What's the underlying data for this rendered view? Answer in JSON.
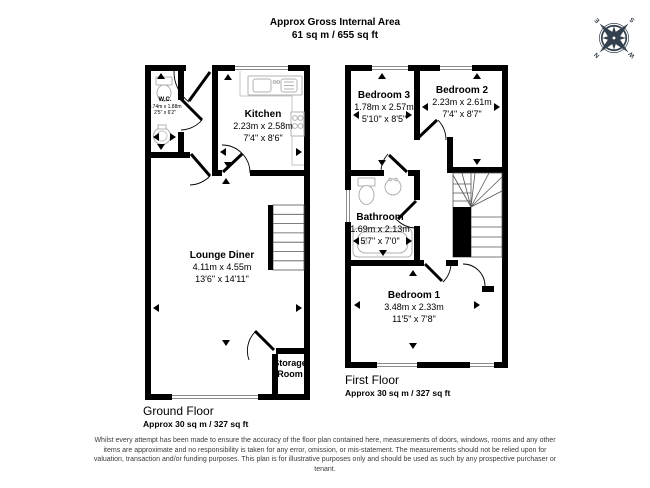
{
  "header": {
    "line1": "Approx Gross Internal Area",
    "line2": "61 sq m / 655 sq ft"
  },
  "compass": {
    "n": "N",
    "e": "E",
    "s": "S",
    "w": "W"
  },
  "ground": {
    "floor_label": "Ground Floor",
    "floor_area": "Approx 30 sq m / 327 sq ft",
    "rooms": {
      "wc": {
        "name": "W.C.",
        "metric": "0.74m x 1.88m",
        "imperial": "2'5\" x 6'2\""
      },
      "kitchen": {
        "name": "Kitchen",
        "metric": "2.23m x 2.58m",
        "imperial": "7'4\" x 8'6\""
      },
      "lounge": {
        "name": "Lounge Diner",
        "metric": "4.11m x 4.55m",
        "imperial": "13'6\" x 14'11\""
      },
      "storage": {
        "name": "Storage Room"
      }
    }
  },
  "first": {
    "floor_label": "First Floor",
    "floor_area": "Approx 30 sq m / 327 sq ft",
    "rooms": {
      "bedroom3": {
        "name": "Bedroom 3",
        "metric": "1.78m x 2.57m",
        "imperial": "5'10\" x 8'5\""
      },
      "bedroom2": {
        "name": "Bedroom 2",
        "metric": "2.23m x 2.61m",
        "imperial": "7'4\" x 8'7\""
      },
      "bathroom": {
        "name": "Bathroom",
        "metric": "1.69m x 2.13m",
        "imperial": "5'7\" x 7'0\""
      },
      "bedroom1": {
        "name": "Bedroom 1",
        "metric": "3.48m x 2.33m",
        "imperial": "11'5\" x 7'8\""
      }
    }
  },
  "disclaimer": "Whilst every attempt has been made to ensure the accuracy of the floor plan contained here, measurements of doors, windows, rooms and any other items are approximate and no responsibility is taken for any error, omission, or mis-statement. The measurements should not be relied upon for valuation, transaction and/or funding purposes. This plan is for illustrative purposes only and should be used as such by any prospective purchaser or tenant.",
  "colors": {
    "wall": "#000000",
    "fixture": "#b0b0b0",
    "window_line": "#8c8c8c",
    "compass": "#33404e"
  }
}
